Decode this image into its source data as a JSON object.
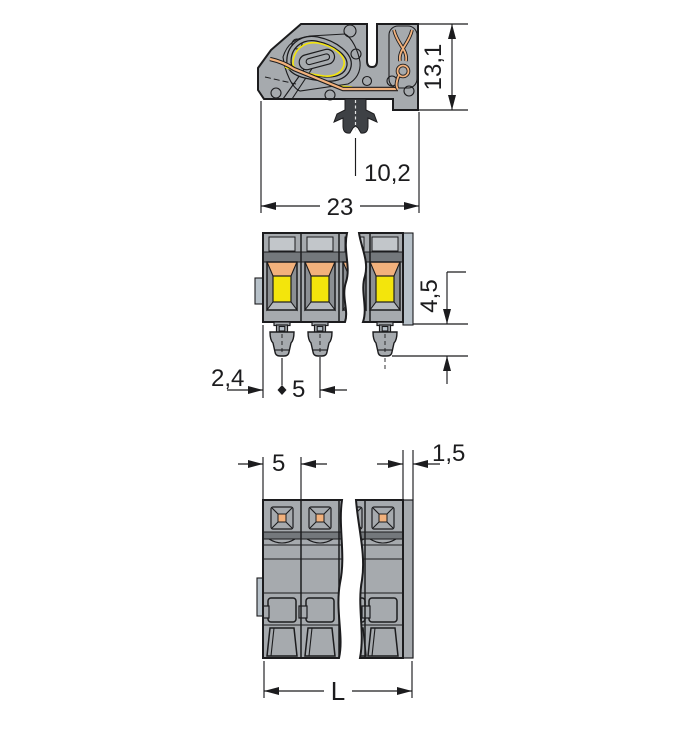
{
  "colors": {
    "line": "#1c1c1e",
    "body": "#a6aaae",
    "recess": "#c2c6ca",
    "band": "#74787c",
    "bevel": "#8b8f93",
    "bevel_light": "#b6babe",
    "tab": "#b7c1c9",
    "yellow": "#f3e50c",
    "orange": "#f2b17c",
    "foot": "#3e4145",
    "bg": "#ffffff"
  },
  "top_view": {
    "dim_height": "13,1",
    "dim_foot_offset": "10,2",
    "dim_width": "23"
  },
  "middle_view": {
    "dim_pin_length": "4,5",
    "dim_edge_offset": "2,4",
    "dim_pitch": "5"
  },
  "bottom_view": {
    "dim_pitch": "5",
    "dim_wall": "1,5",
    "dim_length": "L"
  }
}
